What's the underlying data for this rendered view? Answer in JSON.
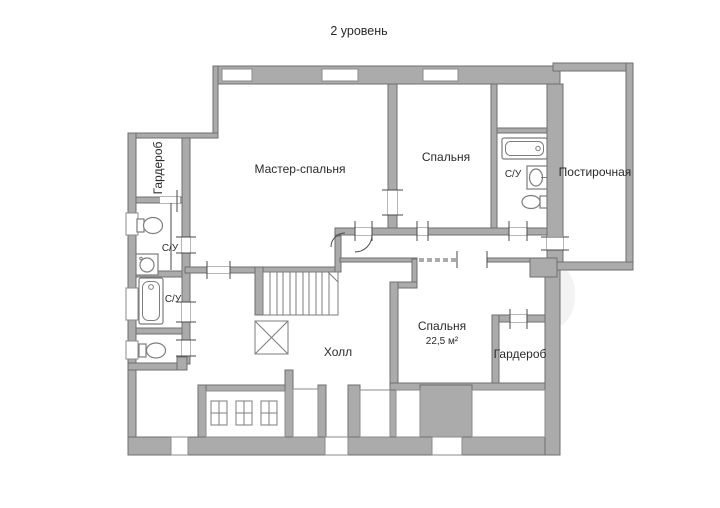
{
  "title": "2 уровень",
  "watermark_text": "Avito",
  "rooms": {
    "wardrobe_left": "Гардероб",
    "bath_upper_left": "С/У",
    "bath_lower_left": "С/У",
    "master_bedroom": "Мастер-спальня",
    "bedroom_top": "Спальня",
    "bath_right": "С/У",
    "laundry": "Постирочная",
    "hall": "Холл",
    "bedroom_second": "Спальня",
    "bedroom_second_area": "22,5 м²",
    "wardrobe_right": "Гардероб"
  },
  "colors": {
    "wall": "#ababab",
    "wall_outline": "#6f6f6f",
    "room": "#ffffff",
    "win_outline": "#8b8b8b",
    "fixture_outline": "#7d7d7d",
    "text": "#2a2a2a",
    "watermark": "#ebebeb"
  }
}
